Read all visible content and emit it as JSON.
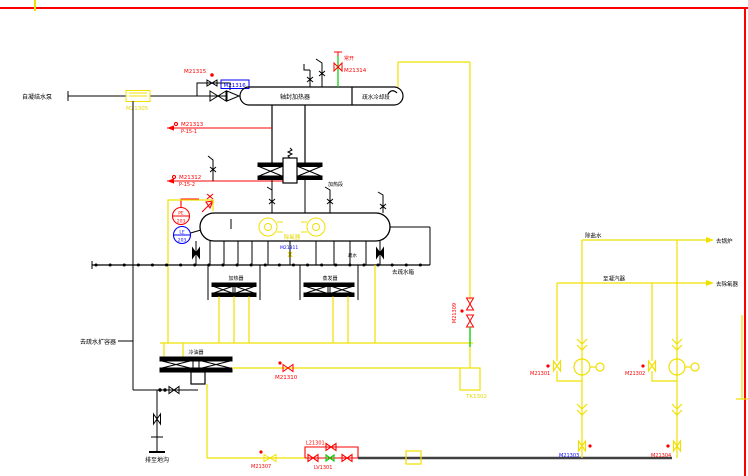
{
  "drawing_type": "CAD P&ID piping diagram (deaerator / heater system)",
  "colors": {
    "background": "#ffffff",
    "pipe_black": "#000000",
    "pipe_yellow": "#f0e000",
    "pipe_red": "#ff0000",
    "pipe_green": "#00cc00",
    "tag_blue": "#0000ff",
    "border_red": "#ff0000",
    "heavy_line_gray": "#404040"
  },
  "labels": {
    "feed_source": "自凝结水泵",
    "strainer_tag": "M21305",
    "valve_m21315": "M21315",
    "valve_m21316": "M21316",
    "vessel_left_section": "轴封加热器",
    "vessel_right_section": "疏水冷却段",
    "normally_open": "常开",
    "valve_m21314": "M21314",
    "steam_line1_tag": "M21313",
    "steam_line1_spec": "P-15-1",
    "steam_line2_tag": "M21312",
    "steam_line2_spec": "P-15-2",
    "mid_heater": "加热段",
    "pe_top": "PE",
    "pe_bottom": "203",
    "le_top": "LE",
    "le_bottom": "203",
    "deaerator": "除氧器",
    "tag_m21311": "M21311",
    "heater_left": "加热器",
    "heater_right": "蒸发器",
    "drain_small": "疏水",
    "to_drain_tank": "去疏水箱",
    "to_flash_tank": "去疏水扩容器",
    "oil_cooler": "冷油器",
    "valve_m21310": "M21310",
    "device_tk1302": "TK1302",
    "valve_m21309": "M21309",
    "drain_ditch": "排至地沟",
    "valve_m21307": "M21307",
    "valve_l21301": "L21301",
    "valve_lv1301": "LV1301",
    "demin_water": "除盐水",
    "to_boiler": "去锅炉",
    "to_condenser": "至凝汽器",
    "to_deaerator": "去除氧器",
    "valve_m21301": "M21301",
    "valve_m21302": "M21302",
    "valve_m21303": "M21303",
    "valve_m21304": "M21304"
  }
}
